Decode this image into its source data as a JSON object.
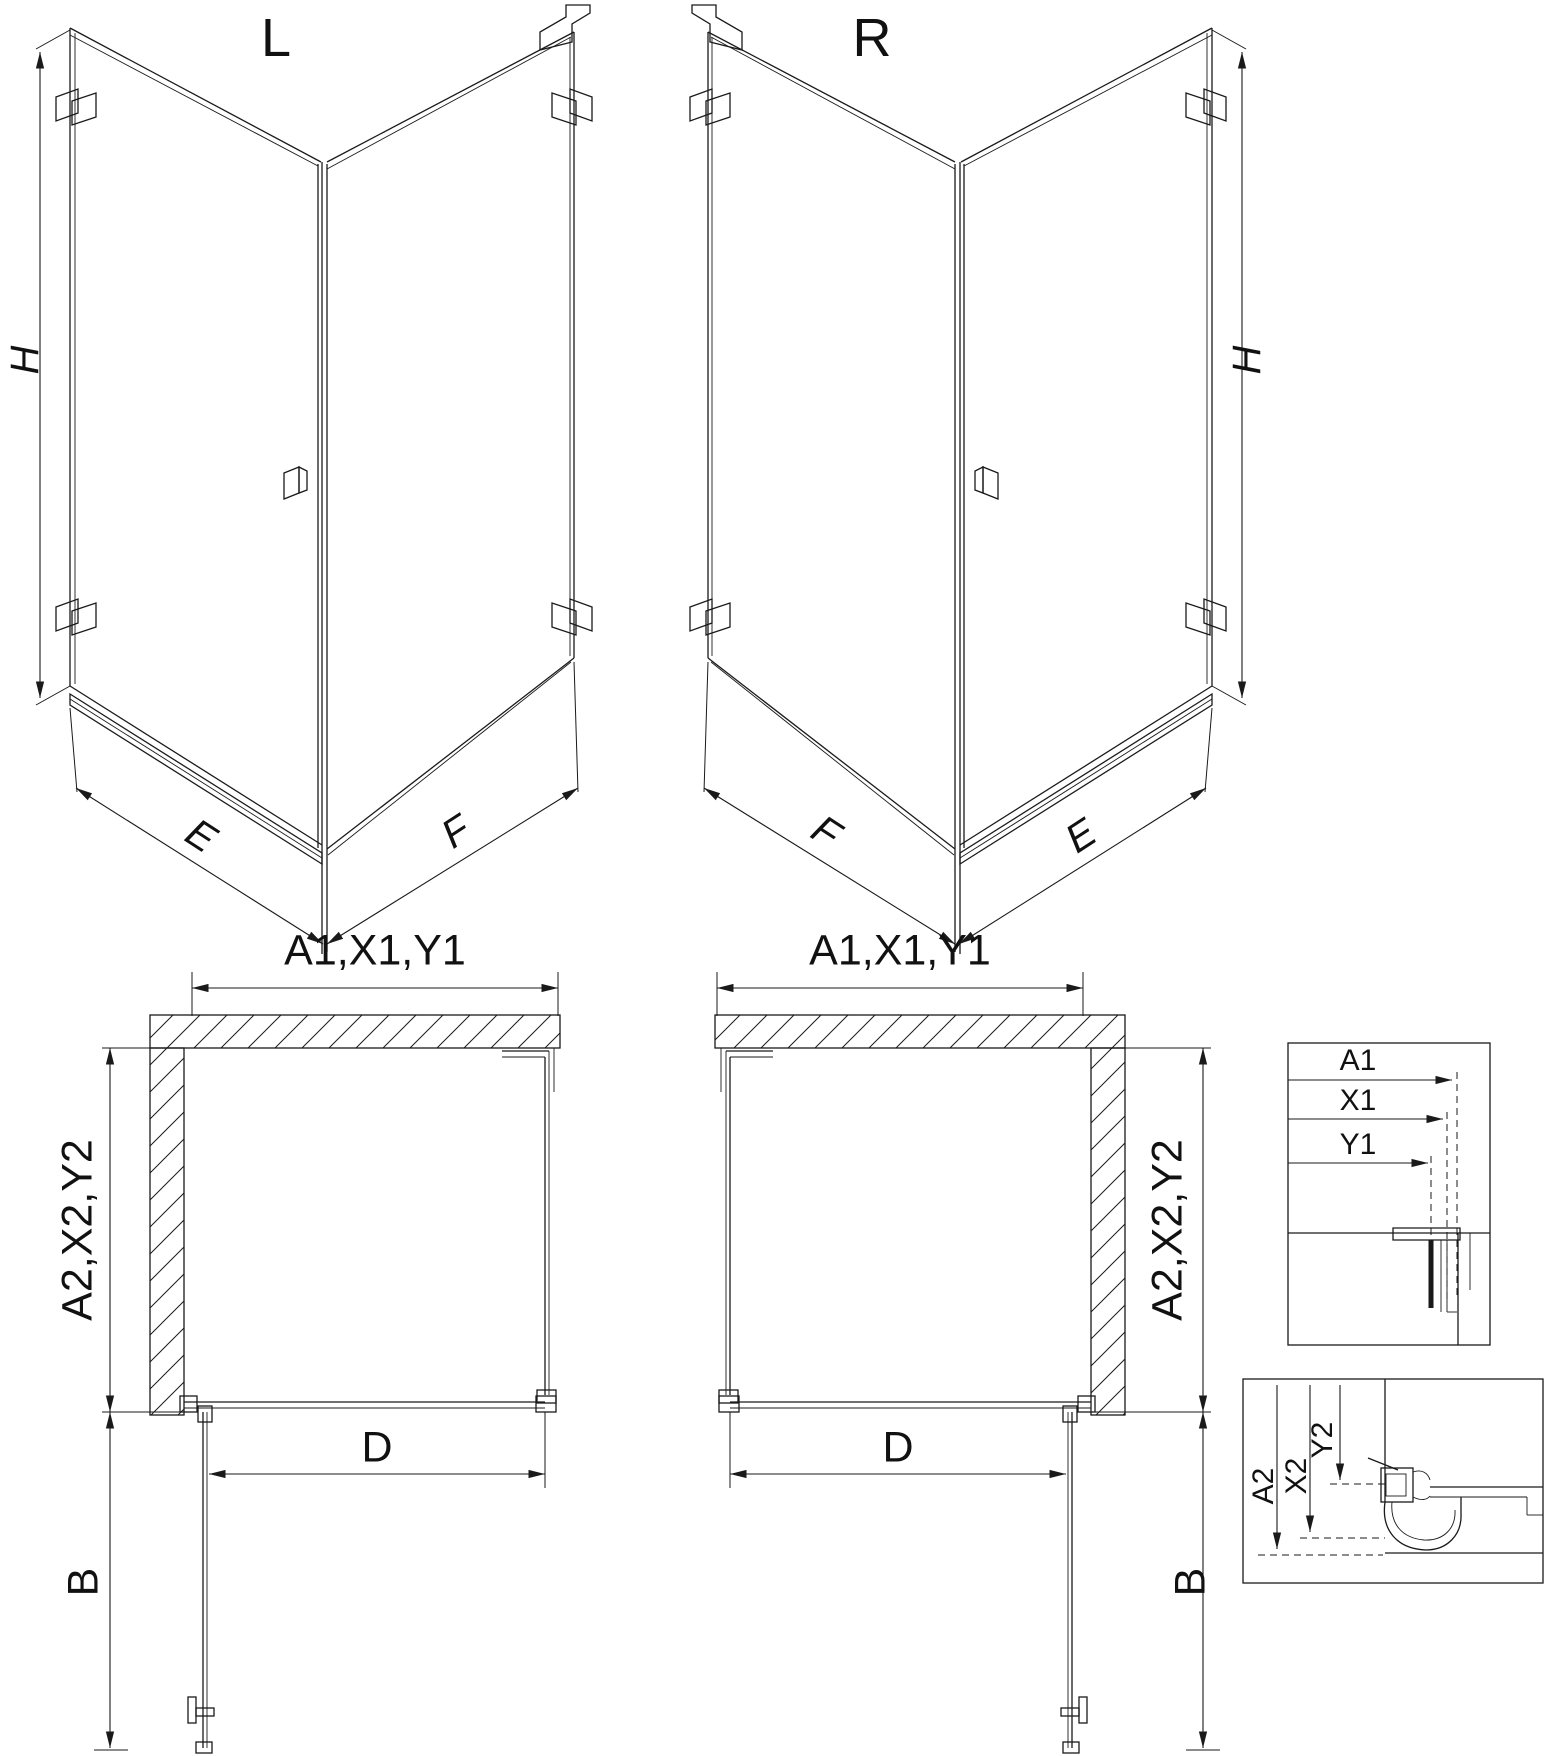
{
  "drawing": {
    "background": "#ffffff",
    "line_color": "#1a1a1a",
    "iso_left": {
      "title": "L",
      "height_label": "H",
      "near_width_label": "E",
      "far_width_label": "F"
    },
    "iso_right": {
      "title": "R",
      "height_label": "H",
      "near_width_label": "F",
      "far_width_label": "E"
    },
    "plan_left": {
      "width_label": "A1,X1,Y1",
      "depth_label": "A2,X2,Y2",
      "door_label": "D",
      "swing_label": "B"
    },
    "plan_right": {
      "width_label": "A1,X1,Y1",
      "depth_label": "A2,X2,Y2",
      "door_label": "D",
      "swing_label": "B"
    },
    "detail_width": {
      "rows": [
        "A1",
        "X1",
        "Y1"
      ]
    },
    "detail_depth": {
      "rows": [
        "A2",
        "X2",
        "Y2"
      ]
    }
  }
}
